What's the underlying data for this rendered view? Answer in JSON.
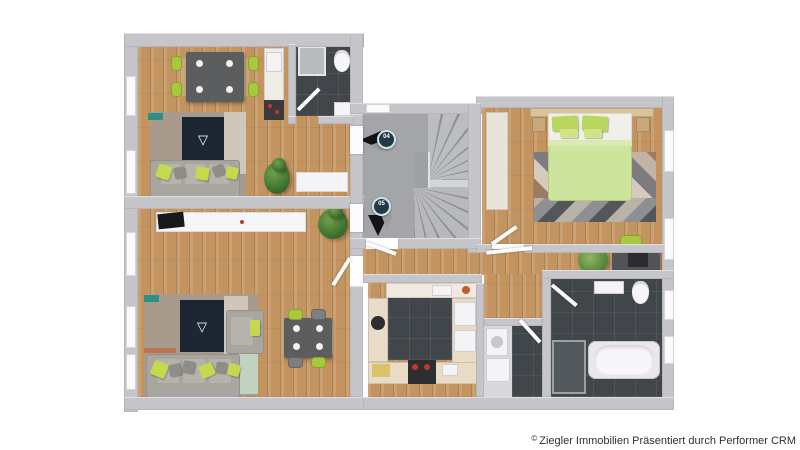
{
  "image": {
    "kind": "3d-floorplan-top-view",
    "background": "#ffffff"
  },
  "watermark": {
    "symbol": "©",
    "text": "Ziegler Immobilien Präsentiert durch Performer CRM"
  },
  "unit_markers": [
    {
      "label": "04",
      "arrow_direction": "left"
    },
    {
      "label": "05",
      "arrow_direction": "down"
    }
  ],
  "palette": {
    "wall_gray": "#c6c6ca",
    "wood_floor": "#c3945f",
    "stair_concrete": "#a4a5a9",
    "dark_tile": "#41464a",
    "accent_green": "#c3da4e",
    "duvet_green": "#cde49c",
    "sofa_gray": "#a9a6a0",
    "rug_taupe": "#a89b8d",
    "marker_badge": "#223a46",
    "fixture_white": "#f4f4f6"
  }
}
